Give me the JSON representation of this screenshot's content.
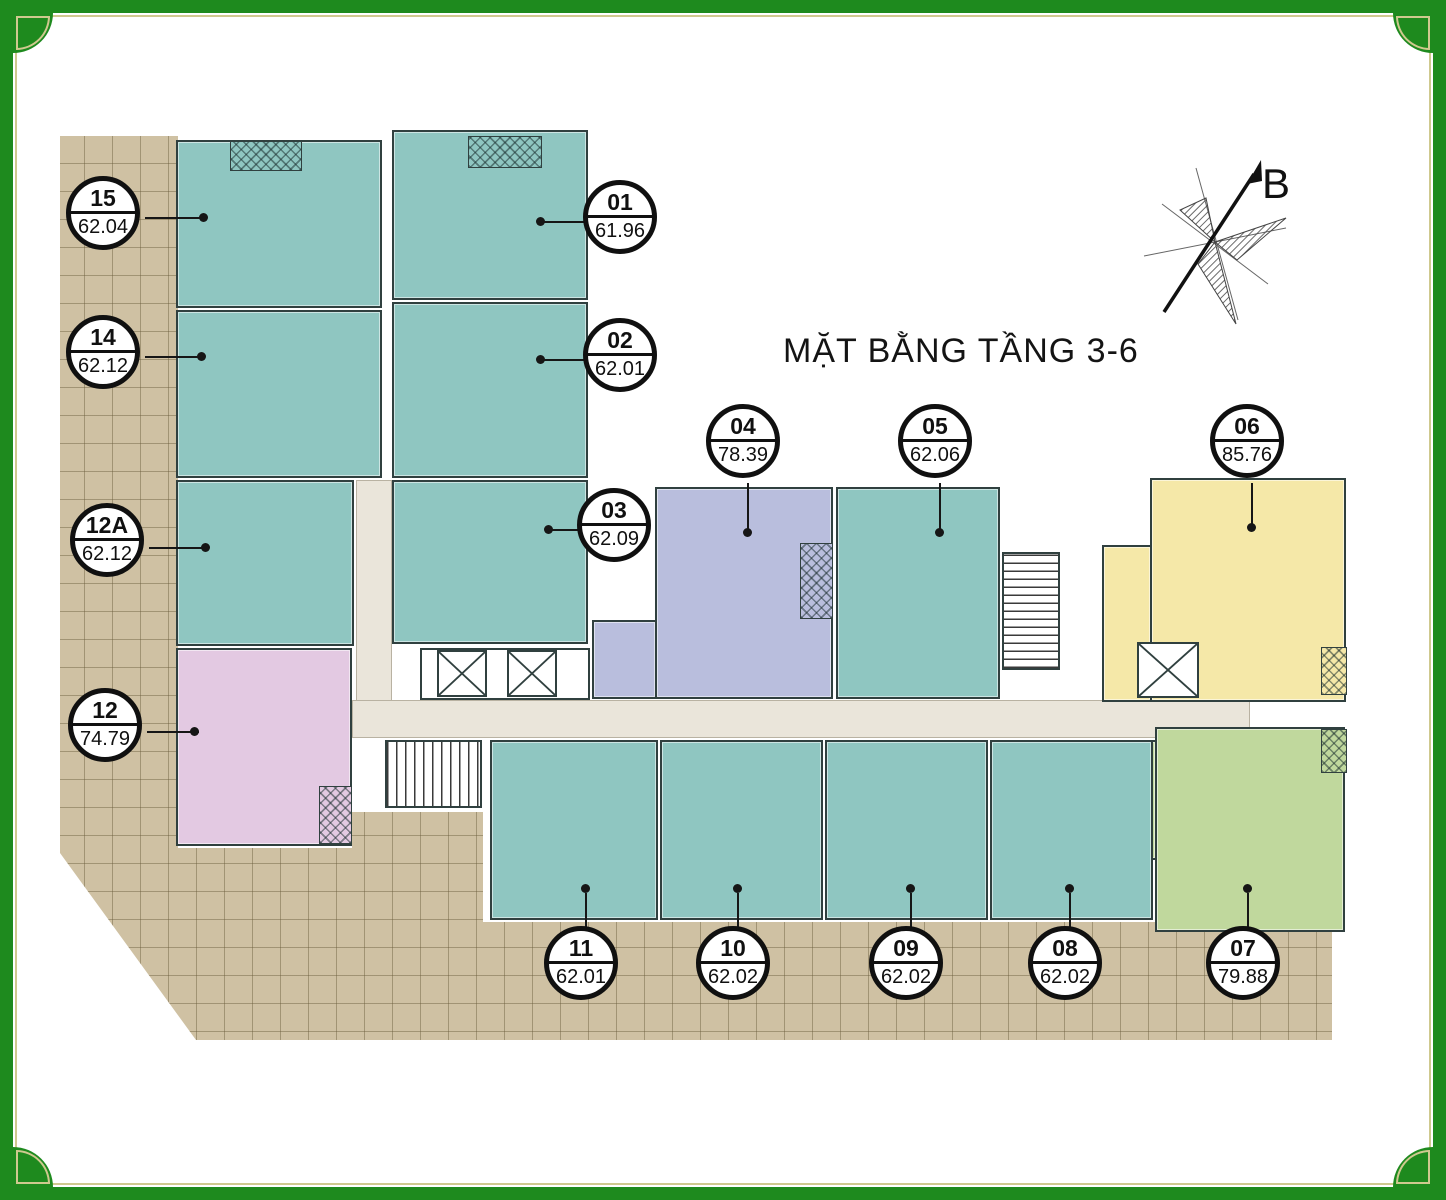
{
  "title": "MẶT BẰNG TẦNG 3-6",
  "compass_label": "B",
  "colors": {
    "teal": "#8fc6c1",
    "purple": "#b9bedd",
    "pink": "#e3c9e2",
    "yellow": "#f5e8a8",
    "green": "#c0d89d",
    "terrace": "#cfc1a3",
    "corridor": "#eae5da",
    "frame": "#1e8a1e"
  },
  "units": [
    {
      "id": "01",
      "area": "61.96",
      "color": "teal"
    },
    {
      "id": "02",
      "area": "62.01",
      "color": "teal"
    },
    {
      "id": "03",
      "area": "62.09",
      "color": "teal"
    },
    {
      "id": "04",
      "area": "78.39",
      "color": "purple"
    },
    {
      "id": "05",
      "area": "62.06",
      "color": "teal"
    },
    {
      "id": "06",
      "area": "85.76",
      "color": "yellow"
    },
    {
      "id": "07",
      "area": "79.88",
      "color": "green"
    },
    {
      "id": "08",
      "area": "62.02",
      "color": "teal"
    },
    {
      "id": "09",
      "area": "62.02",
      "color": "teal"
    },
    {
      "id": "10",
      "area": "62.02",
      "color": "teal"
    },
    {
      "id": "11",
      "area": "62.01",
      "color": "teal"
    },
    {
      "id": "12",
      "area": "74.79",
      "color": "pink"
    },
    {
      "id": "12A",
      "area": "62.12",
      "color": "teal"
    },
    {
      "id": "14",
      "area": "62.12",
      "color": "teal"
    },
    {
      "id": "15",
      "area": "62.04",
      "color": "teal"
    }
  ]
}
